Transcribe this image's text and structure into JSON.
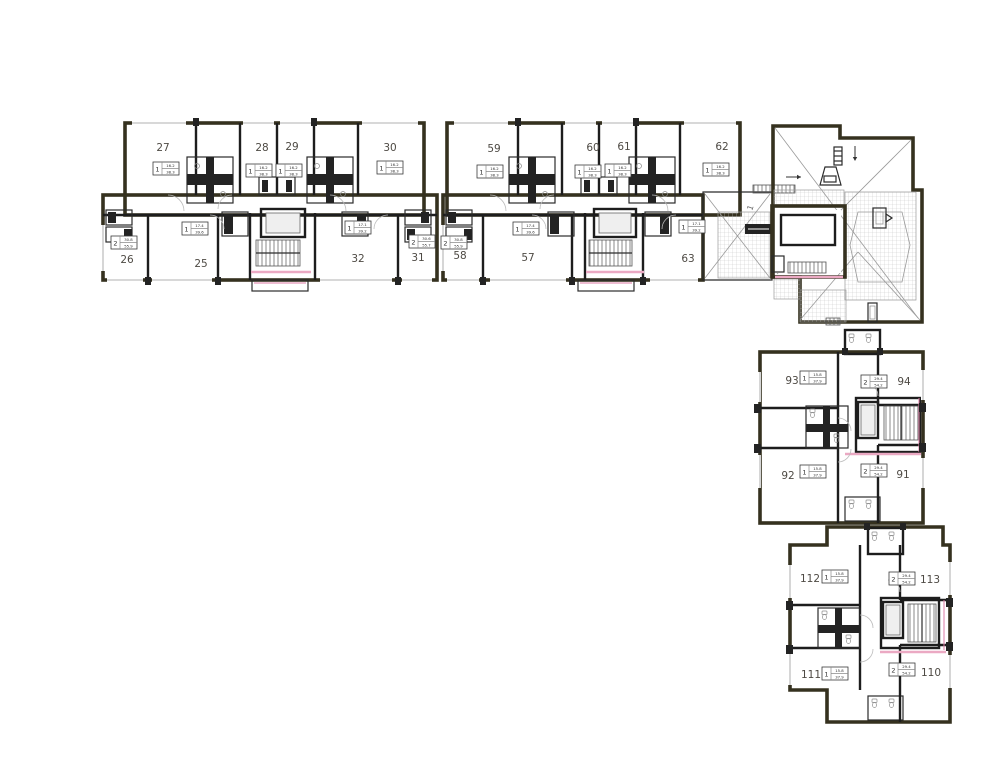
{
  "colors": {
    "wall": "#35311f",
    "partition": "#1d1d1d",
    "accent_pink": "#eba9c3",
    "accent_pink_dark": "#de7ba4",
    "hatch_gray": "#c9c9c9",
    "text_gray": "#4e4a44"
  },
  "roof": {
    "ramp_label": "1"
  },
  "units": {
    "u25": {
      "num": "25",
      "rooms": "1",
      "area_top": "17.4",
      "area_bot": "39.6"
    },
    "u26": {
      "num": "26",
      "rooms": "2",
      "area_top": "30.8",
      "area_bot": "55.9"
    },
    "u27": {
      "num": "27",
      "rooms": "1",
      "area_top": "16.2",
      "area_bot": "38.3"
    },
    "u28": {
      "num": "28",
      "rooms": "1",
      "area_top": "16.2",
      "area_bot": "38.3"
    },
    "u29": {
      "num": "29",
      "rooms": "1",
      "area_top": "16.2",
      "area_bot": "38.3"
    },
    "u30": {
      "num": "30",
      "rooms": "1",
      "area_top": "16.2",
      "area_bot": "38.3"
    },
    "u31": {
      "num": "31",
      "rooms": "2",
      "area_top": "30.6",
      "area_bot": "55.7"
    },
    "u32": {
      "num": "32",
      "rooms": "1",
      "area_top": "17.1",
      "area_bot": "39.2"
    },
    "u57": {
      "num": "57",
      "rooms": "1",
      "area_top": "17.4",
      "area_bot": "39.6"
    },
    "u58": {
      "num": "58",
      "rooms": "2",
      "area_top": "30.8",
      "area_bot": "55.9"
    },
    "u59": {
      "num": "59",
      "rooms": "1",
      "area_top": "16.2",
      "area_bot": "38.3"
    },
    "u60": {
      "num": "60",
      "rooms": "1",
      "area_top": "16.2",
      "area_bot": "38.3"
    },
    "u61": {
      "num": "61",
      "rooms": "1",
      "area_top": "16.2",
      "area_bot": "38.3"
    },
    "u62": {
      "num": "62",
      "rooms": "1",
      "area_top": "16.2",
      "area_bot": "38.3"
    },
    "u63": {
      "num": "63",
      "rooms": "1",
      "area_top": "17.1",
      "area_bot": "39.2"
    },
    "u91": {
      "num": "91",
      "rooms": "2",
      "area_top": "29.4",
      "area_bot": "54.2"
    },
    "u92": {
      "num": "92",
      "rooms": "1",
      "area_top": "15.8",
      "area_bot": "37.9"
    },
    "u93": {
      "num": "93",
      "rooms": "1",
      "area_top": "15.8",
      "area_bot": "37.9"
    },
    "u94": {
      "num": "94",
      "rooms": "2",
      "area_top": "29.4",
      "area_bot": "54.2"
    },
    "u110": {
      "num": "110",
      "rooms": "2",
      "area_top": "29.4",
      "area_bot": "54.2"
    },
    "u111": {
      "num": "111",
      "rooms": "1",
      "area_top": "15.8",
      "area_bot": "37.9"
    },
    "u112": {
      "num": "112",
      "rooms": "1",
      "area_top": "15.8",
      "area_bot": "37.9"
    },
    "u113": {
      "num": "113",
      "rooms": "2",
      "area_top": "29.4",
      "area_bot": "54.2"
    }
  }
}
